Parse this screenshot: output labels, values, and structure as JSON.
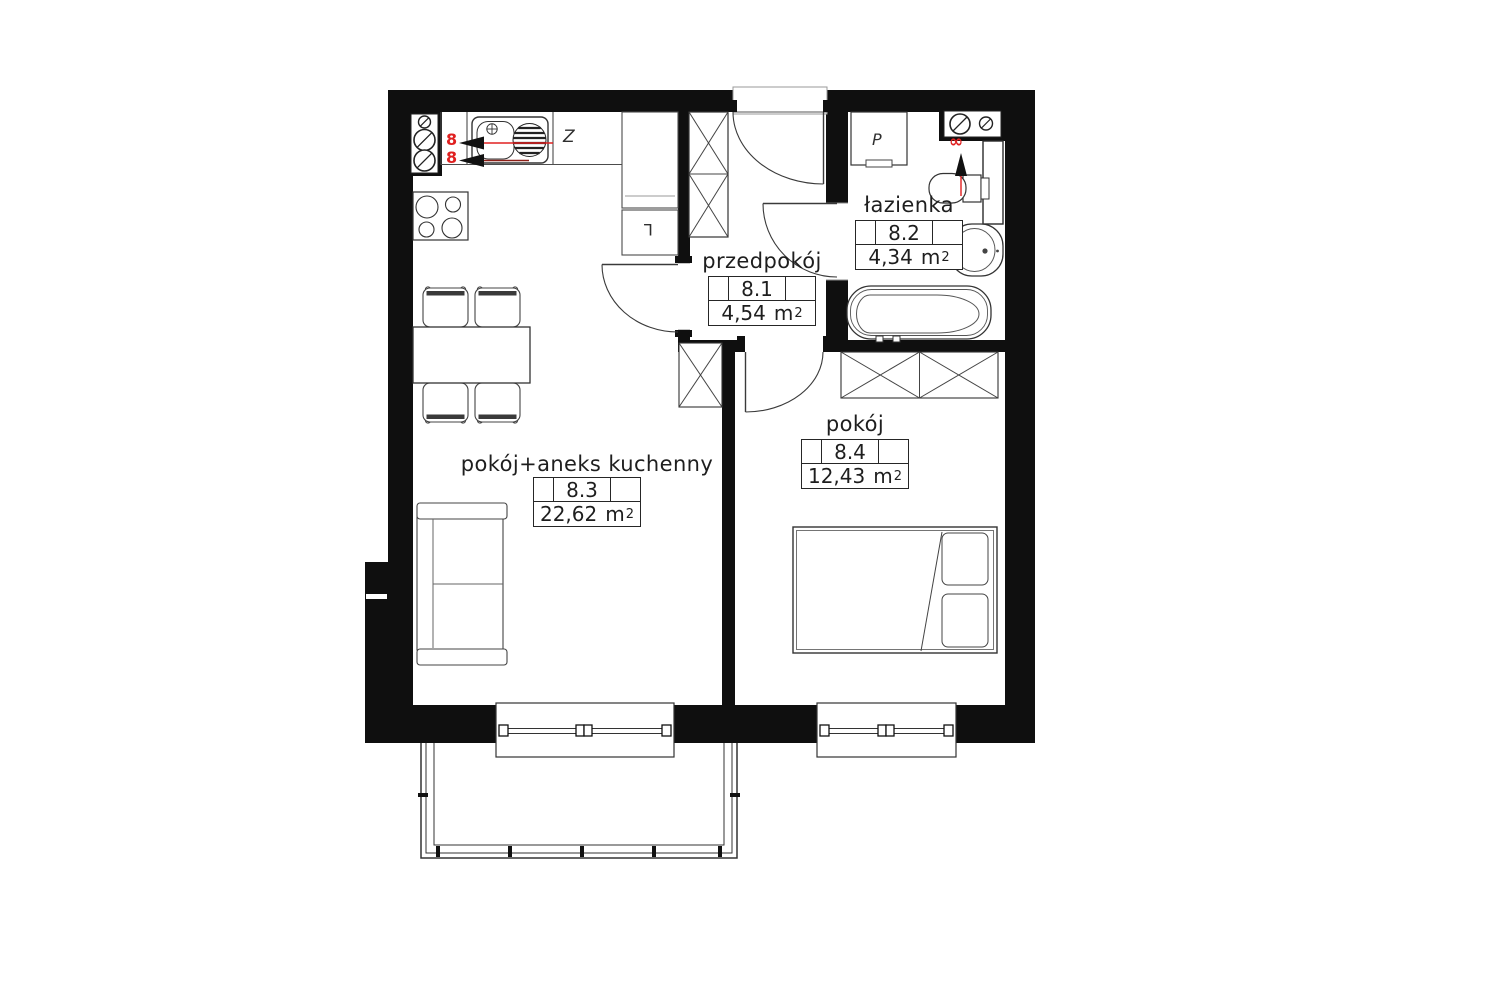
{
  "plan": {
    "type": "apartment-floor-plan",
    "unit": {
      "base": "m",
      "exp": "2"
    },
    "rooms": [
      {
        "number": "8.1",
        "name": "przedpokój",
        "area": "4,54"
      },
      {
        "number": "8.2",
        "name": "łazienka",
        "area": "4,34"
      },
      {
        "number": "8.3",
        "name": "pokój+aneks kuchenny",
        "area": "22,62"
      },
      {
        "number": "8.4",
        "name": "pokój",
        "area": "12,43"
      }
    ],
    "appliance_labels": {
      "dishwasher": "Z",
      "fridge": "L",
      "washing_machine": "P"
    },
    "riser_marks": {
      "kitchen_top": "8",
      "kitchen_bottom": "8",
      "bathroom": "∞"
    },
    "colors": {
      "wall": "#0f0f0f",
      "furniture_line": "#4c4c4c",
      "accent_red": "#e02020",
      "accent_dark_red": "#8d1f17",
      "text": "#1e1e1e",
      "background": "#ffffff"
    }
  }
}
